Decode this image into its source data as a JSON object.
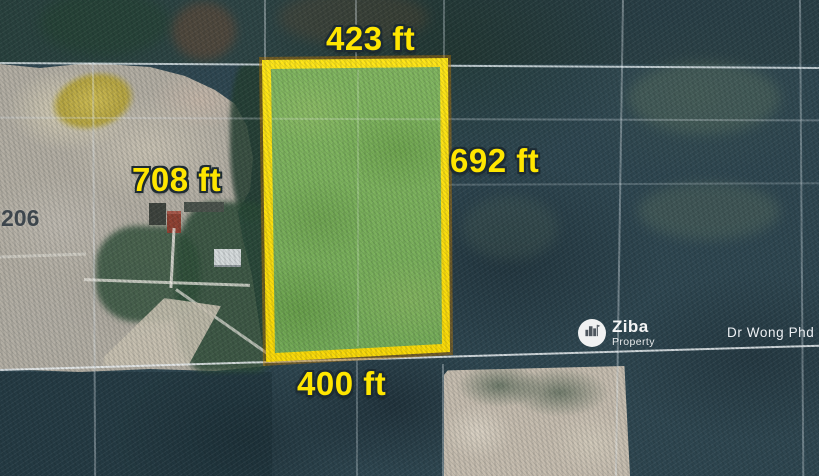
{
  "map": {
    "lot_number": "206",
    "credit": "Dr Wong Phd"
  },
  "parcel": {
    "dimensions": {
      "top": "423 ft",
      "right": "692 ft",
      "left": "708 ft",
      "bottom": "400 ft"
    }
  },
  "watermark": {
    "brand": "Ziba",
    "brand_sub": "Property",
    "icon": "buildings-icon"
  },
  "colors": {
    "parcel_outline": "#ffdf00",
    "parcel_fill": "#79b25c",
    "dimension_text": "#ffe600",
    "forest": "#2e4650",
    "cleared_land": "#b2ada2"
  }
}
